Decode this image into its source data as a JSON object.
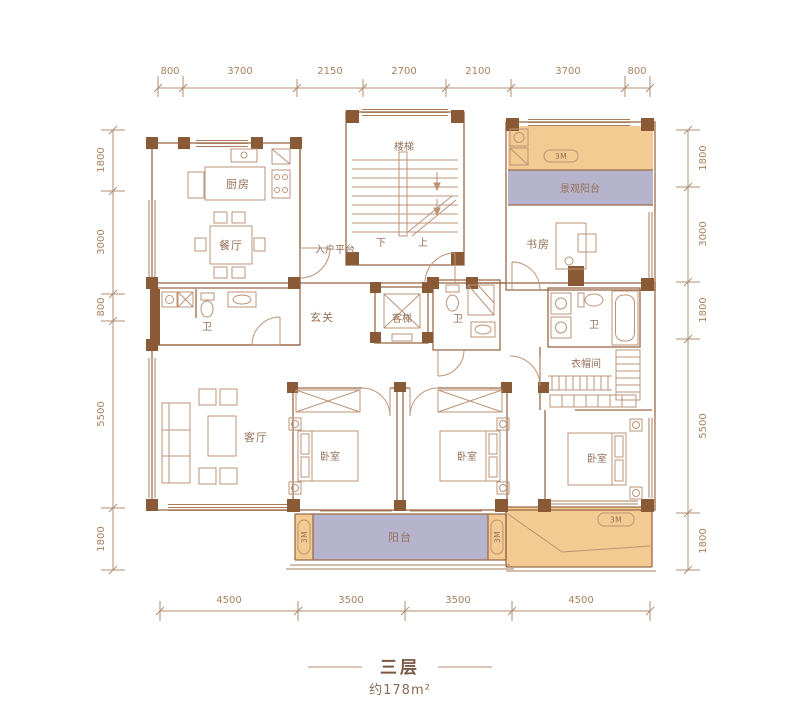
{
  "title": {
    "floor": "三层",
    "area": "约178m²"
  },
  "dimensions": {
    "top": [
      "800",
      "3700",
      "2150",
      "2700",
      "2100",
      "3700",
      "800"
    ],
    "bottom": [
      "4500",
      "3500",
      "3500",
      "4500"
    ],
    "left": [
      "1800",
      "3000",
      "800",
      "5500",
      "1800"
    ],
    "right": [
      "1800",
      "3000",
      "1800",
      "5500",
      "1800"
    ]
  },
  "rooms": {
    "kitchen": "厨房",
    "dining": "餐厅",
    "stairs": "楼梯",
    "stairs_down": "下",
    "stairs_up": "上",
    "entry_platform": "入户平台",
    "view_balcony": "景观阳台",
    "study": "书房",
    "foyer": "玄关",
    "bath_left": "卫",
    "bath_center": "卫",
    "bath_right": "卫",
    "elevator": "客梯",
    "cloakroom": "衣帽间",
    "living": "客厅",
    "bedroom_a": "卧室",
    "bedroom_b": "卧室",
    "bedroom_c": "卧室",
    "balcony": "阳台"
  },
  "badges": {
    "height_marker": "3M"
  },
  "colors": {
    "wall": "#8a5936",
    "line": "#9b6a47",
    "balcony_fill": "#b6b4cc",
    "terrace_fill": "#f3ca92",
    "dim_text": "#aa8263"
  }
}
